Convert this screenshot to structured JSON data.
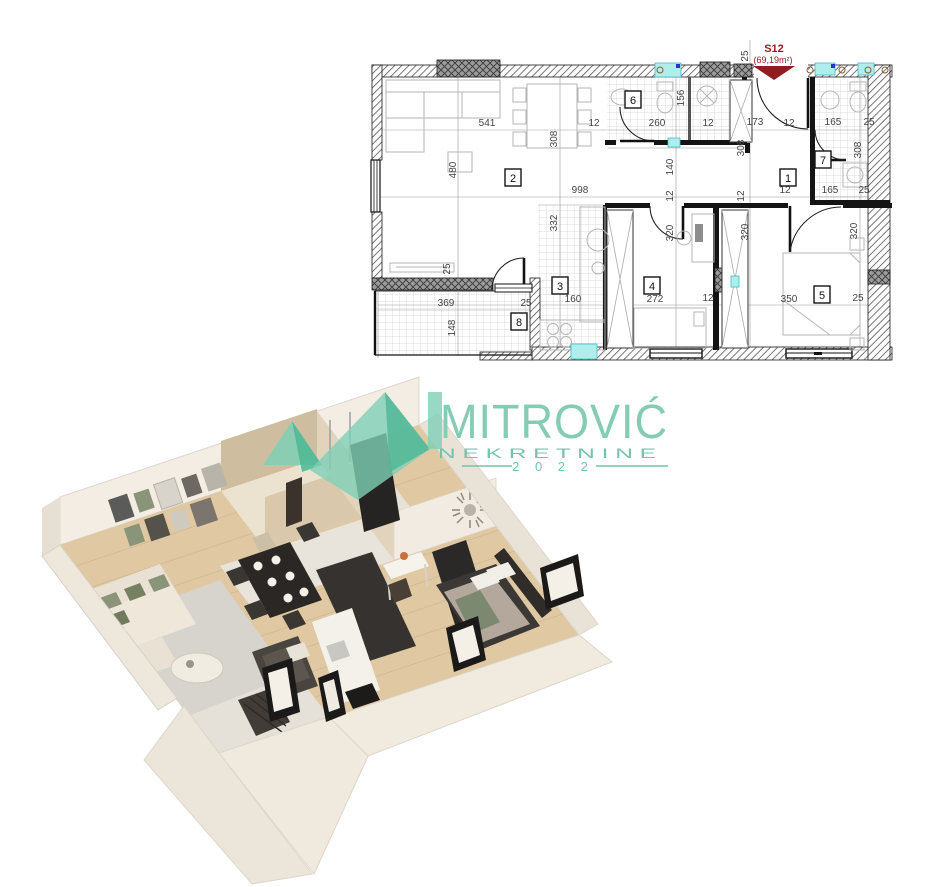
{
  "unit": {
    "id": "S12",
    "area": "(69,19m²)",
    "accent_color": "#9c1b1e"
  },
  "logo": {
    "name": "MITROVIĆ",
    "subtitle": "N E K R E T N I N E",
    "year": "2 0 2 2",
    "teal": "#7ed0b6"
  },
  "floorplan": {
    "room_numbers": [
      {
        "n": "1",
        "x": 788,
        "y": 178
      },
      {
        "n": "2",
        "x": 513,
        "y": 178
      },
      {
        "n": "3",
        "x": 560,
        "y": 286
      },
      {
        "n": "4",
        "x": 652,
        "y": 286
      },
      {
        "n": "5",
        "x": 822,
        "y": 295
      },
      {
        "n": "6",
        "x": 633,
        "y": 100
      },
      {
        "n": "7",
        "x": 823,
        "y": 160
      },
      {
        "n": "8",
        "x": 519,
        "y": 322
      }
    ],
    "dimensions": [
      {
        "t": "541",
        "x": 487,
        "y": 126
      },
      {
        "t": "12",
        "x": 594,
        "y": 126
      },
      {
        "t": "260",
        "x": 657,
        "y": 126
      },
      {
        "t": "12",
        "x": 708,
        "y": 126
      },
      {
        "t": "173",
        "x": 755,
        "y": 125
      },
      {
        "t": "12",
        "x": 789,
        "y": 126
      },
      {
        "t": "165",
        "x": 833,
        "y": 125
      },
      {
        "t": "25",
        "x": 869,
        "y": 125
      },
      {
        "t": "25",
        "x": 748,
        "y": 56,
        "r": -90
      },
      {
        "t": "308",
        "x": 557,
        "y": 139,
        "r": -90
      },
      {
        "t": "480",
        "x": 456,
        "y": 170,
        "r": -90
      },
      {
        "t": "156",
        "x": 684,
        "y": 98,
        "r": -90
      },
      {
        "t": "308",
        "x": 744,
        "y": 148,
        "r": -90
      },
      {
        "t": "308",
        "x": 861,
        "y": 150,
        "r": -90
      },
      {
        "t": "998",
        "x": 580,
        "y": 193
      },
      {
        "t": "140",
        "x": 673,
        "y": 167,
        "r": -90
      },
      {
        "t": "12",
        "x": 673,
        "y": 196,
        "r": -90
      },
      {
        "t": "12",
        "x": 744,
        "y": 196,
        "r": -90
      },
      {
        "t": "12",
        "x": 785,
        "y": 193
      },
      {
        "t": "165",
        "x": 830,
        "y": 193
      },
      {
        "t": "25",
        "x": 864,
        "y": 193
      },
      {
        "t": "332",
        "x": 557,
        "y": 223,
        "r": -90
      },
      {
        "t": "320",
        "x": 673,
        "y": 233,
        "r": -90
      },
      {
        "t": "320",
        "x": 748,
        "y": 232,
        "r": -90
      },
      {
        "t": "320",
        "x": 857,
        "y": 231,
        "r": -90
      },
      {
        "t": "25",
        "x": 450,
        "y": 269,
        "r": -90
      },
      {
        "t": "160",
        "x": 573,
        "y": 302
      },
      {
        "t": "272",
        "x": 655,
        "y": 302
      },
      {
        "t": "12",
        "x": 708,
        "y": 301
      },
      {
        "t": "350",
        "x": 789,
        "y": 302
      },
      {
        "t": "25",
        "x": 858,
        "y": 301
      },
      {
        "t": "369",
        "x": 446,
        "y": 306
      },
      {
        "t": "25",
        "x": 526,
        "y": 306
      },
      {
        "t": "148",
        "x": 455,
        "y": 328,
        "r": -90
      }
    ]
  }
}
